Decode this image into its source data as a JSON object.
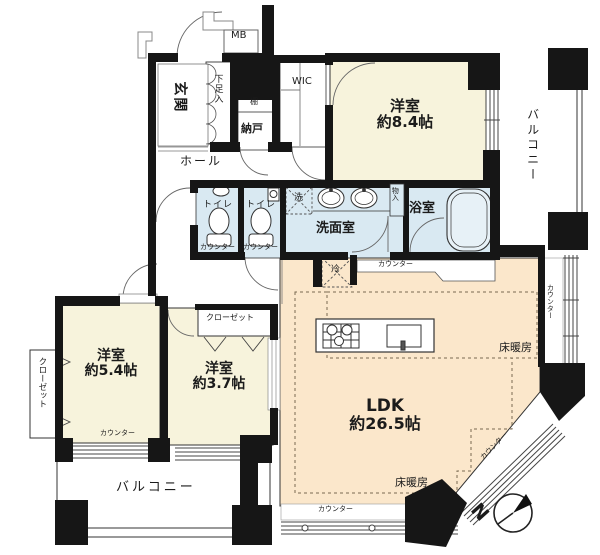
{
  "floorplan": {
    "compass_label": "N",
    "colors": {
      "wall": "#161616",
      "bedroom_fill": "#f7f3dc",
      "ldk_fill": "#fbe7cb",
      "wet_area_fill": "#d9e9f2",
      "balcony_fill": "#ffffff",
      "heating_dash": "#7a6a50"
    },
    "rooms": {
      "genkan": "玄関",
      "shoe_cabinet": "下足入",
      "meter_box": "MB",
      "shelf": "棚",
      "storage": "納戸",
      "wic": "WIC",
      "hall": "ホール",
      "bedroom84": {
        "name": "洋室",
        "size": "約8.4帖"
      },
      "balcony_east": "バルコニー",
      "toilet_1": "トイレ",
      "toilet_2": "トイレ",
      "washer": "洗",
      "washroom": "洗面室",
      "storage_small": "物入",
      "bathroom": "浴室",
      "fridge": "冷",
      "ldk": {
        "name": "LDK",
        "size": "約26.5帖"
      },
      "bedroom54": {
        "name": "洋室",
        "size": "約5.4帖"
      },
      "bedroom37": {
        "name": "洋室",
        "size": "約3.7帖"
      },
      "closet_west": "クローゼット",
      "closet_37": "クローゼット",
      "balcony_south": "バルコニー"
    },
    "features": {
      "floor_heating_east": "床暖房",
      "floor_heating_south": "床暖房",
      "counter_kitchen": "カウンター",
      "counter_east": "カウンター",
      "counter_diagonal": "カウンター",
      "counter_toilet_1": "カウンター",
      "counter_toilet_2": "カウンター",
      "counter_bedroom54": "カウンター",
      "counter_south": "カウンター"
    }
  }
}
